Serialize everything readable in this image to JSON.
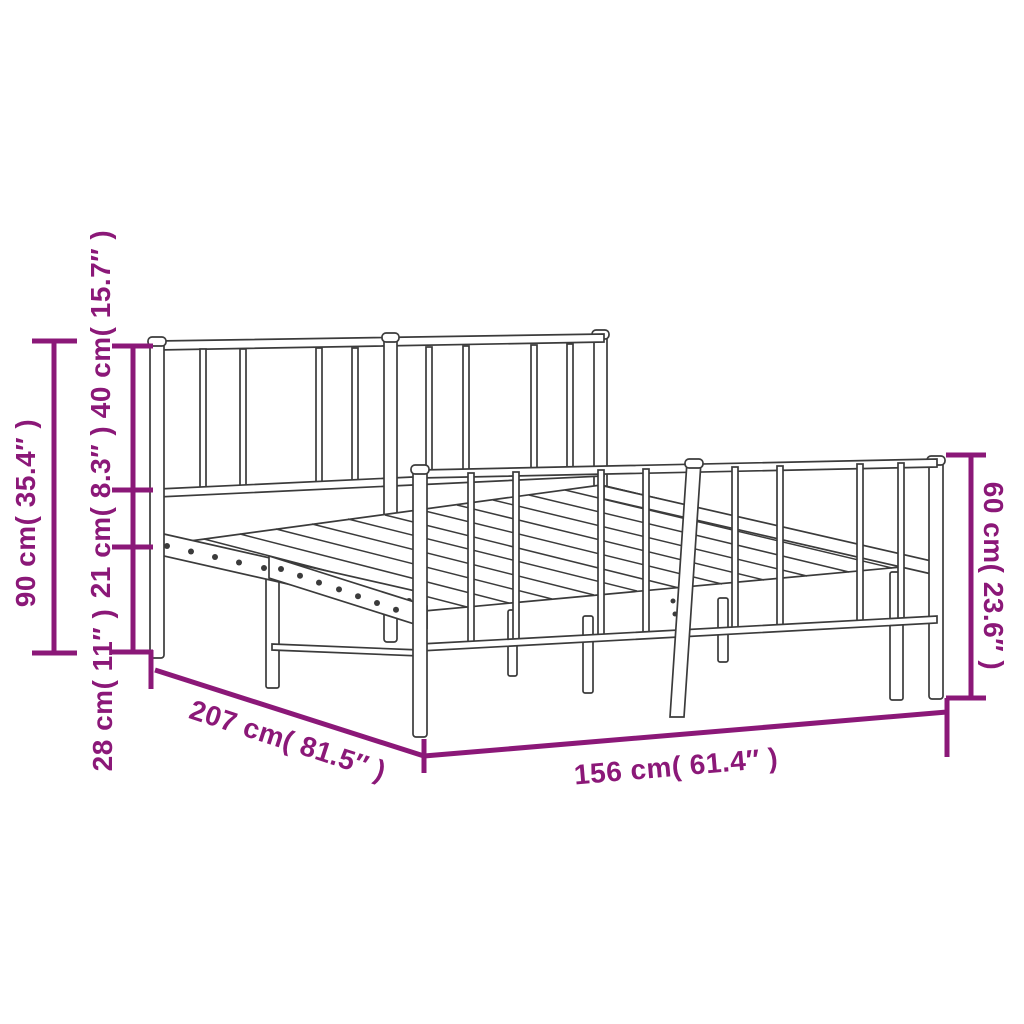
{
  "title": "Metal bed frame with headboard and footboard — dimension diagram",
  "colors": {
    "dimension_annotation": "#8b1878",
    "drawing_line": "#3b3b3b",
    "background": "#ffffff"
  },
  "dimensions": {
    "overall_height": "90 cm( 35.4″ )",
    "headboard_top_section": "40 cm( 15.7″ )",
    "rail_section": "21 cm( 8.3″ )",
    "ground_clearance": "28 cm( 11″ )",
    "frame_length": "207 cm( 81.5″ )",
    "frame_width": "156 cm( 61.4″ )",
    "footboard_height": "60 cm( 23.6″ )"
  }
}
